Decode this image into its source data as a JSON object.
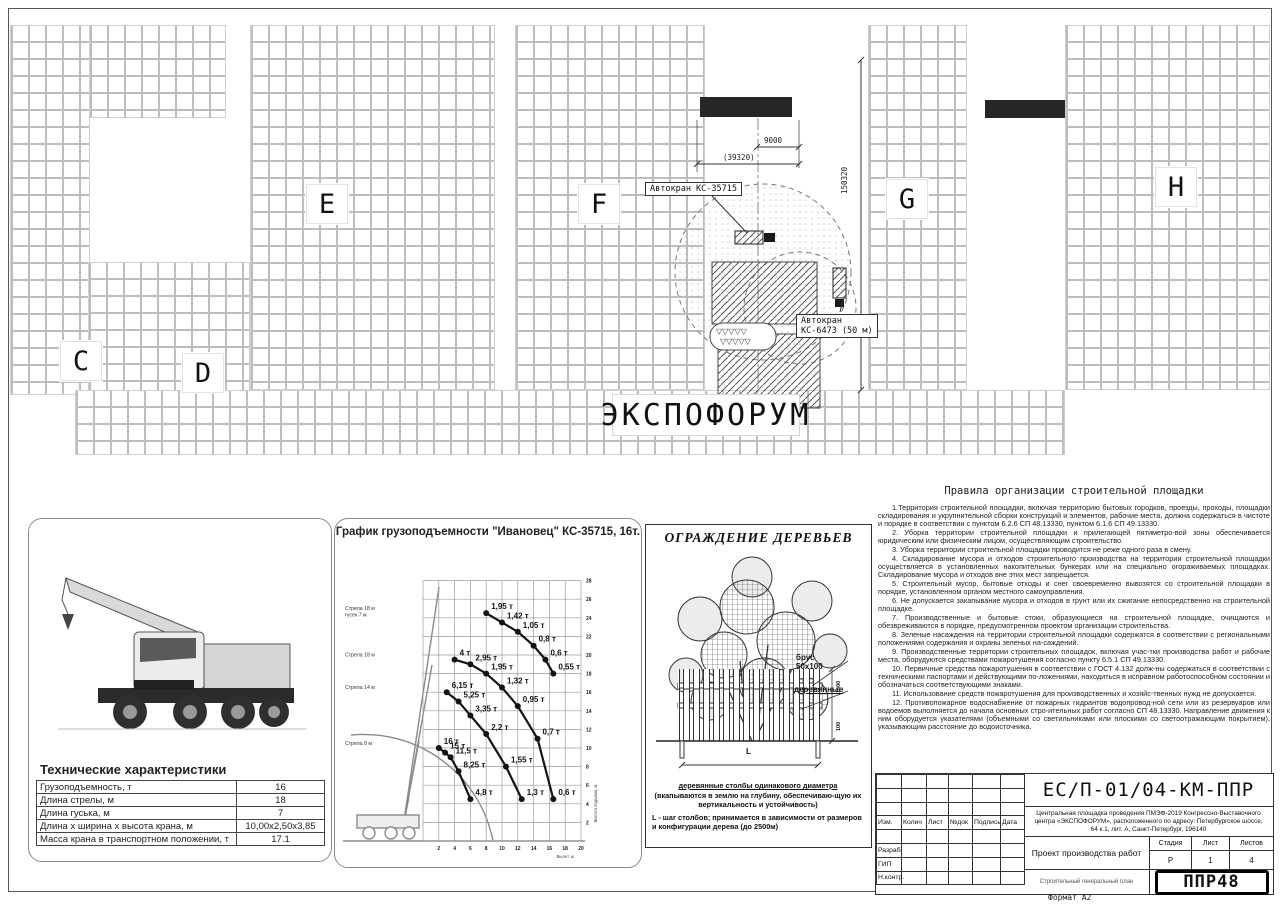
{
  "plan": {
    "building_labels": [
      "C",
      "D",
      "E",
      "F",
      "G",
      "H"
    ],
    "expo_label": "ЭКСПОФОРУМ",
    "crane1_callout": "Автокран КС-35715",
    "crane2_callout_line1": "Автокран",
    "crane2_callout_line2": "КС-6473 (50 м)",
    "dims": {
      "d9000": "9000",
      "d39320": "(39320)",
      "d150320": "150320"
    }
  },
  "specs": {
    "title": "Технические характеристики",
    "rows": [
      {
        "label": "Грузоподъемность, т",
        "value": "16"
      },
      {
        "label": "Длина стрелы, м",
        "value": "18"
      },
      {
        "label": "Длина гуська, м",
        "value": "7"
      },
      {
        "label": "Длина х ширина х высота крана, м",
        "value": "10,00х2,50х3,85"
      },
      {
        "label": "Масса крана в транспортном положении, т",
        "value": "17.1"
      }
    ]
  },
  "chart_data": {
    "type": "line",
    "title": "График грузоподъемности \"Ивановец\" КС-35715, 16т.",
    "xlabel": "Вылет, м",
    "ylabel": "Высота подъема, м",
    "xlim": [
      0,
      20
    ],
    "ylim": [
      0,
      28
    ],
    "xticks": [
      2,
      4,
      6,
      8,
      10,
      12,
      14,
      16,
      18,
      20
    ],
    "yticks": [
      2,
      4,
      6,
      8,
      10,
      12,
      14,
      16,
      18,
      20,
      22,
      24,
      26,
      28
    ],
    "grid": true,
    "units": "т",
    "series": [
      {
        "name": "Стрела 18 м\nгусек 7 м",
        "points": [
          {
            "x": 8,
            "h": 24.5,
            "label": "1,95 т"
          },
          {
            "x": 10,
            "h": 23.5,
            "label": "1,42 т"
          },
          {
            "x": 12,
            "h": 22.5,
            "label": "1,05 т"
          },
          {
            "x": 14,
            "h": 21,
            "label": "0,8 т"
          },
          {
            "x": 15.5,
            "h": 19.5,
            "label": "0,6 т"
          },
          {
            "x": 16.5,
            "h": 18,
            "label": "0,55 т"
          }
        ]
      },
      {
        "name": "Стрела 18 м",
        "points": [
          {
            "x": 4,
            "h": 19.5,
            "label": "4 т"
          },
          {
            "x": 6,
            "h": 19,
            "label": "2,95 т"
          },
          {
            "x": 8,
            "h": 18,
            "label": "1,95 т"
          },
          {
            "x": 10,
            "h": 16.5,
            "label": "1,32 т"
          },
          {
            "x": 12,
            "h": 14.5,
            "label": "0,95 т"
          },
          {
            "x": 14.5,
            "h": 11,
            "label": "0,7 т"
          },
          {
            "x": 16.5,
            "h": 4.5,
            "label": "0,6 т"
          }
        ]
      },
      {
        "name": "Стрела 14 м",
        "points": [
          {
            "x": 3,
            "h": 16,
            "label": "6,15 т"
          },
          {
            "x": 4.5,
            "h": 15,
            "label": "5,25 т"
          },
          {
            "x": 6,
            "h": 13.5,
            "label": "3,35 т"
          },
          {
            "x": 8,
            "h": 11.5,
            "label": "2,2 т"
          },
          {
            "x": 10.5,
            "h": 8,
            "label": "1,55 т"
          },
          {
            "x": 12.5,
            "h": 4.5,
            "label": "1,3 т"
          }
        ]
      },
      {
        "name": "Стрела 8 м",
        "points": [
          {
            "x": 2,
            "h": 10,
            "label": "16 т"
          },
          {
            "x": 2.8,
            "h": 9.5,
            "label": "15 т"
          },
          {
            "x": 3.5,
            "h": 9,
            "label": "11,5 т"
          },
          {
            "x": 4.5,
            "h": 7.5,
            "label": "8,25 т"
          },
          {
            "x": 6,
            "h": 4.5,
            "label": "4,8 т"
          }
        ]
      }
    ]
  },
  "tree": {
    "title": "ОГРАЖДЕНИЕ ДЕРЕВЬЕВ",
    "label_bar_1": "брус",
    "label_bar_2": "50х100",
    "label_wood": "деревянные",
    "dim_1500": "1500",
    "dim_100": "100",
    "dim_L": "L",
    "note_posts": "деревянные столбы одинакового диаметра",
    "note_depth": "(вкапываются в землю на глубину, обеспечиваю-щую их вертикальность и устойчивость)",
    "note_step": "L - шаг столбов; принимается в зависимости от размеров и конфигурации дерева (до 2500м)"
  },
  "rules": {
    "title": "Правила организации строительной площадки",
    "items": [
      "1.Территория строительной площадки, включая территорию бытовых городков, проезды, проходы, площадки складирования и укрупнительной сборки конструкций и элементов, рабочие места, должна содержаться в чистоте и порядке в соответствии с пунктом 6.2.6 СП 48.13330, пунктом 6.1.6 СП 49.13330.",
      "2. Уборка территории строительной площадки и прилегающей пятиметро-вой зоны обеспечивается юридическим или физическим лицом, осуществляющим строительство.",
      "3. Уборка территории строительной площадки проводится не реже одного раза в смену.",
      "4. Складирование мусора и отходов строительного производства на территории строительной площадки осуществляется в установленных накопительных бункерах или на специально огораживаемых площадках. Складирование мусора и отходов вне этих мест запрещается.",
      "5. Строительный мусор, бытовые отходы и снег своевременно вывозятся со строительной площадки в порядке, установленном органом местного самоуправления.",
      "6. Не допускается закапывание мусора и отходов в грунт или их сжигание непосредственно на строительной площадке.",
      "7. Производственные и бытовые стоки, образующиеся на строительной площадке, очищаются и обезвреживаются в порядке, предусмотренном проектом организации строительства.",
      "8. Зеленые насаждения на территории строительной площадки содержатся в соответствии с региональными положениями содержания и охраны зеленых на-саждений.",
      "9. Производственные территории строительных площадок, включая учас-тки производства работ и рабочие места, оборудуются средствами пожаротушения согласно пункту 6.5.1 СП 49.13330.",
      "10. Первичные средства пожаротушения в соответствии с ГОСТ 4.132 долж-ны содержаться в соответствии с техническими паспортами и действующими по-ложениями, находиться в исправном работоспособном состоянии и обозначаться соответствующими знаками.",
      "11. Использование средств пожаротушения для производственных и хозяйс-твенных нужд не допускается.",
      "12. Противопожарное водоснабжение от пожарных гидрантов водопровод-ной сети или из резервуаров или водоемов выполняется до начала основных стро-ительных работ согласно СП 48.13330. Направление движения к ним оборудуется указателями (объемными со светильниками или плоскими со светоотражающим покрытием), указывающим расстояние до водоисточника."
    ]
  },
  "titleblock": {
    "doc_number": "ЕС/П-01/04-КМ-ППР",
    "project": "Центральная площадка проведения ПМЭФ-2019 Конгрессно-Выставочного центра «ЭКСПОФОРУМ», расположенного по адресу: Петербургское шоссе, 64 к.1, лит. А, Санкт-Петербург, 196140",
    "doc_title": "Проект производства работ",
    "sheet_title": "Строительный генеральный план",
    "columns": [
      "Изм.",
      "Колич",
      "Лист",
      "№док",
      "Подпись",
      "Дата"
    ],
    "sign_rows": [
      "Разраб.",
      "ГИП",
      "Н.контр."
    ],
    "stage_label": "Стадия",
    "sheet_label": "Лист",
    "sheets_label": "Листов",
    "stage_value": "Р",
    "sheet_value": "1",
    "sheets_value": "4",
    "logo": "ППР48"
  },
  "format_label": "Формат А2"
}
